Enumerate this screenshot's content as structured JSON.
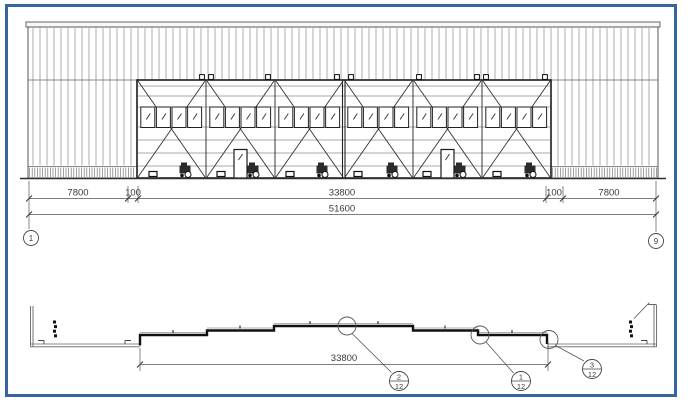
{
  "frame": {
    "border_color": "#36659f"
  },
  "elevation": {
    "dims_row1": [
      "7800",
      "100",
      "33800",
      "100",
      "7800"
    ],
    "dims_total": "51600",
    "grid_left": "1",
    "grid_right": "9"
  },
  "plan": {
    "dim_door": "33800",
    "detail_callouts": [
      {
        "number": "2",
        "sheet": "12"
      },
      {
        "number": "1",
        "sheet": "12"
      },
      {
        "number": "3",
        "sheet": "12"
      }
    ]
  }
}
